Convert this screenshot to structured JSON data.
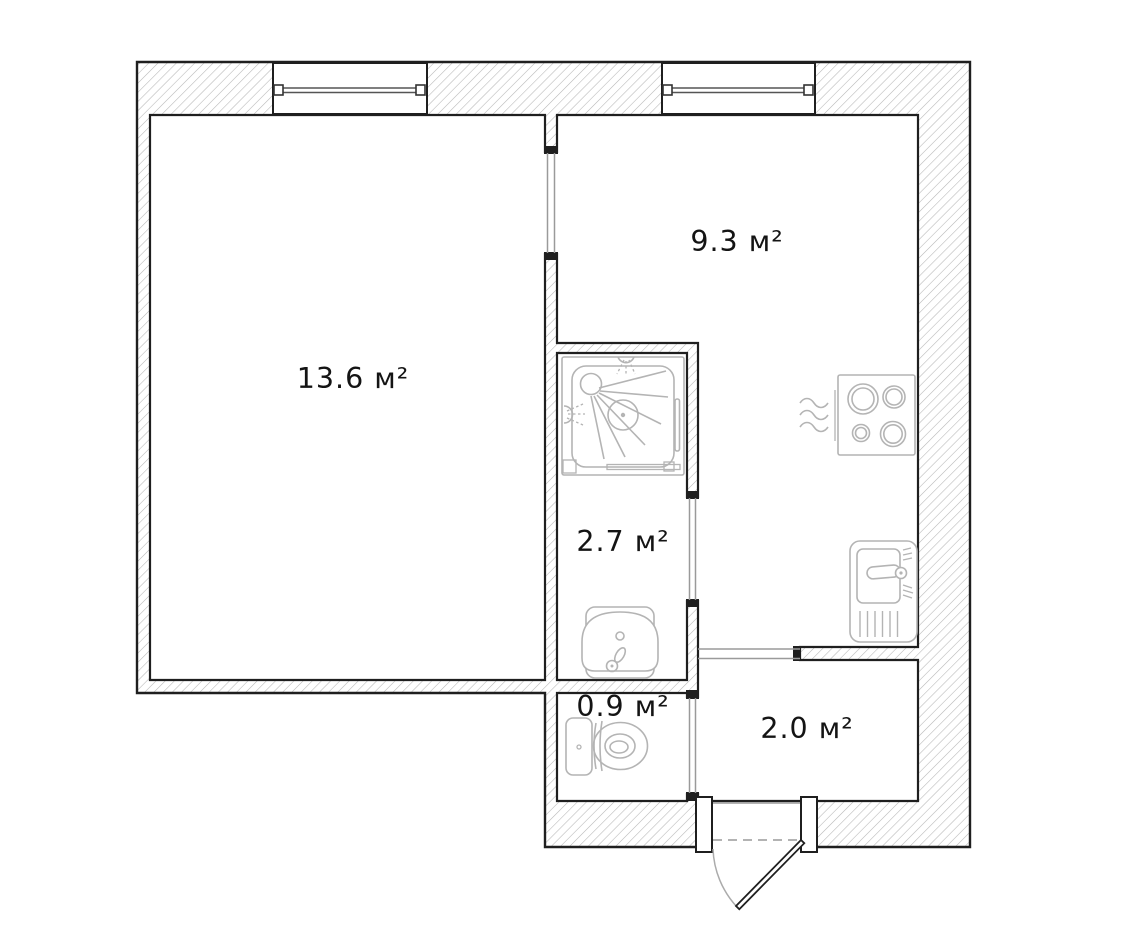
{
  "plan": {
    "unit_suffix": "м²",
    "rooms": [
      {
        "id": "living-room",
        "area_label": "13.6 м²"
      },
      {
        "id": "kitchen",
        "area_label": "9.3 м²"
      },
      {
        "id": "bathroom",
        "area_label": "2.7 м²"
      },
      {
        "id": "toilet",
        "area_label": "0.9 м²"
      },
      {
        "id": "hallway",
        "area_label": "2.0 м²"
      }
    ],
    "fixtures": [
      {
        "icon": "shower-cabin-icon"
      },
      {
        "icon": "washbasin-icon"
      },
      {
        "icon": "toilet-icon"
      },
      {
        "icon": "cooktop-icon"
      },
      {
        "icon": "kitchen-sink-icon"
      }
    ],
    "features": [
      "window",
      "window",
      "entrance-door"
    ],
    "colors": {
      "wall_outline": "#1f1f1f",
      "wall_hatch": "#b6b6b6",
      "fixture_line": "#b4b4b4",
      "opening_line": "#9a9a9a",
      "label_text": "#141414",
      "background": "#ffffff"
    }
  }
}
